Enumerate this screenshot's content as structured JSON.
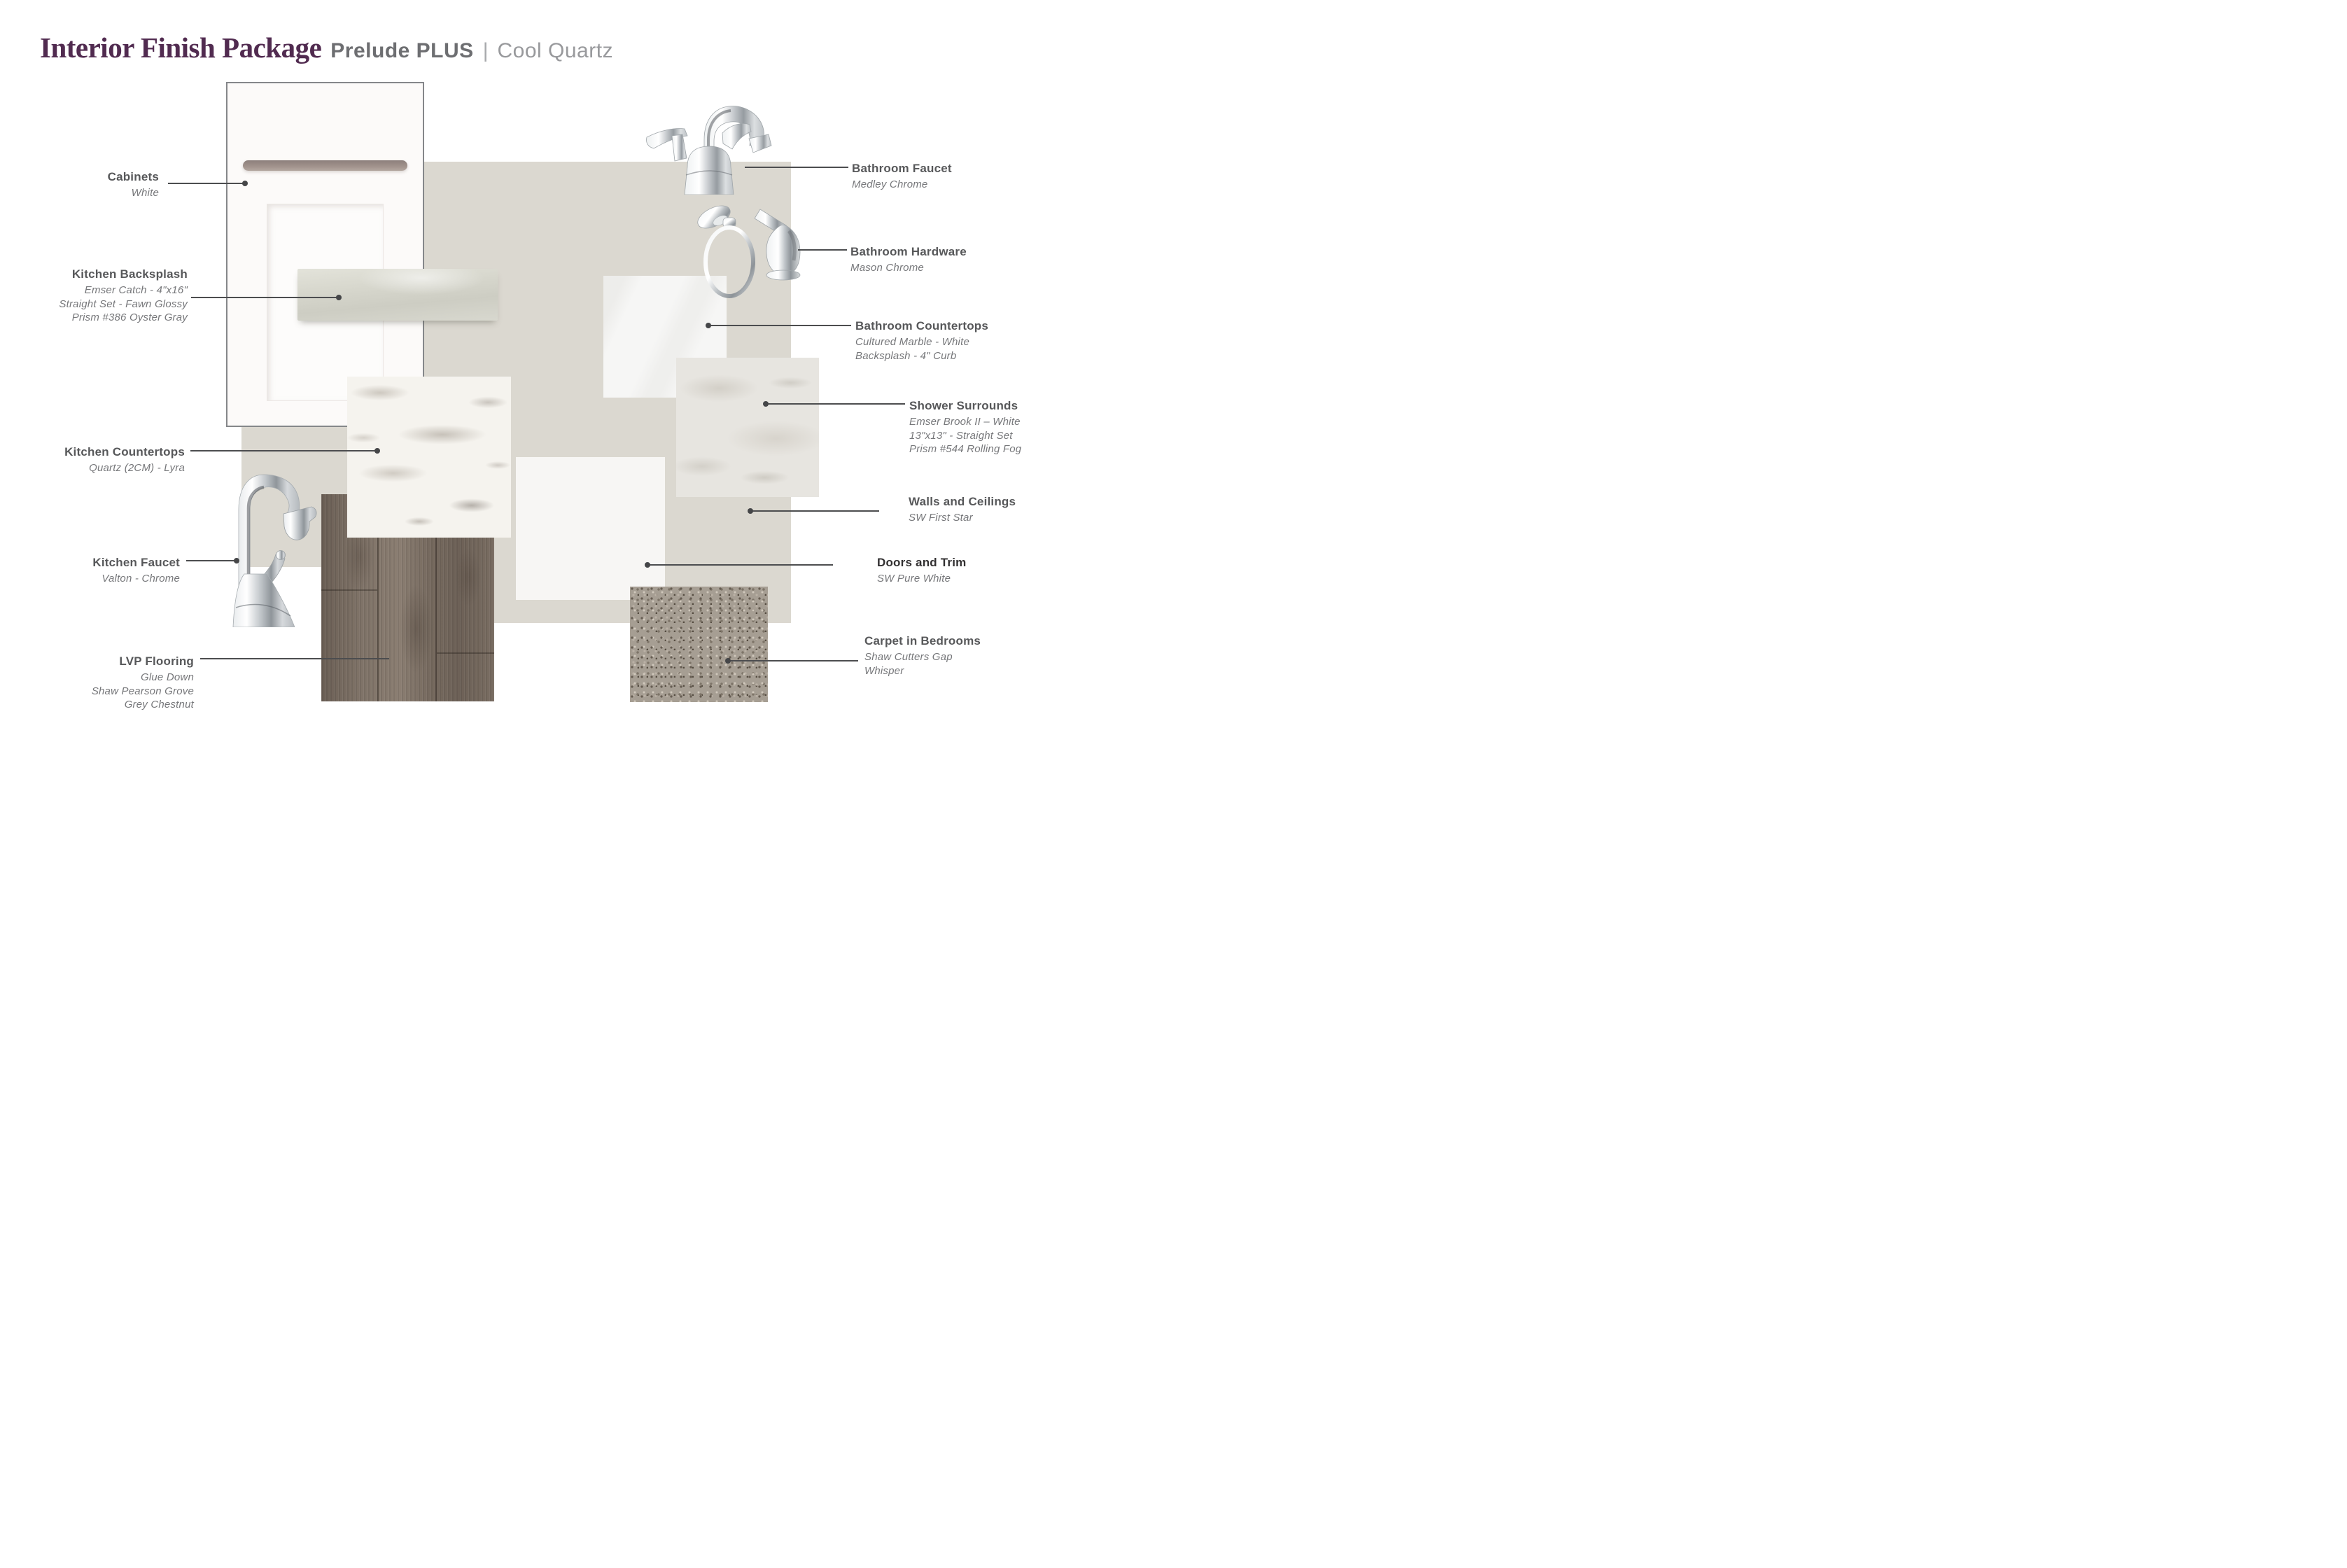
{
  "header": {
    "title": "Interior Finish Package",
    "package": "Prelude PLUS",
    "divider": "|",
    "palette": "Cool Quartz"
  },
  "labels": {
    "cabinets": {
      "title": "Cabinets",
      "details": [
        "White"
      ]
    },
    "kitchen_backsplash": {
      "title": "Kitchen Backsplash",
      "details": [
        "Emser Catch - 4\"x16\"",
        "Straight Set - Fawn Glossy",
        "Prism #386 Oyster Gray"
      ]
    },
    "kitchen_countertops": {
      "title": "Kitchen Countertops",
      "details": [
        "Quartz (2CM)  - Lyra"
      ]
    },
    "kitchen_faucet": {
      "title": "Kitchen Faucet",
      "details": [
        "Valton - Chrome"
      ]
    },
    "lvp_flooring": {
      "title": "LVP Flooring",
      "details": [
        "Glue Down",
        "Shaw Pearson Grove",
        "Grey Chestnut"
      ]
    },
    "bathroom_faucet": {
      "title": "Bathroom Faucet",
      "details": [
        "Medley Chrome"
      ]
    },
    "bathroom_hardware": {
      "title": "Bathroom Hardware",
      "details": [
        "Mason Chrome"
      ]
    },
    "bathroom_countertops": {
      "title": "Bathroom Countertops",
      "details": [
        "Cultured Marble - White",
        "Backsplash - 4\" Curb"
      ]
    },
    "shower_surrounds": {
      "title": "Shower Surrounds",
      "details": [
        "Emser Brook II – White",
        "13\"x13\" - Straight Set",
        "Prism #544 Rolling Fog"
      ]
    },
    "walls_and_ceilings": {
      "title": "Walls and Ceilings",
      "details": [
        "SW First Star"
      ]
    },
    "doors_and_trim": {
      "title": "Doors and Trim",
      "details": [
        "SW Pure White"
      ]
    },
    "carpet_in_bedrooms": {
      "title": "Carpet in Bedrooms",
      "details": [
        "Shaw Cutters Gap",
        "Whisper"
      ]
    }
  },
  "palette_colors": {
    "title_accent": "#512b50",
    "header_gray": "#6d6e71",
    "header_light_gray": "#98999c",
    "label_title_gray": "#57585a",
    "label_detail_gray": "#76777a",
    "leader_line": "#4c4d4f",
    "backdrop_greige": "#dbd8d0",
    "carpet_taupe": "#a69e93",
    "lvp_brown": "#7a6e63",
    "doors_trim_white": "#f7f6f4",
    "quartz_white": "#f5f3ee"
  }
}
